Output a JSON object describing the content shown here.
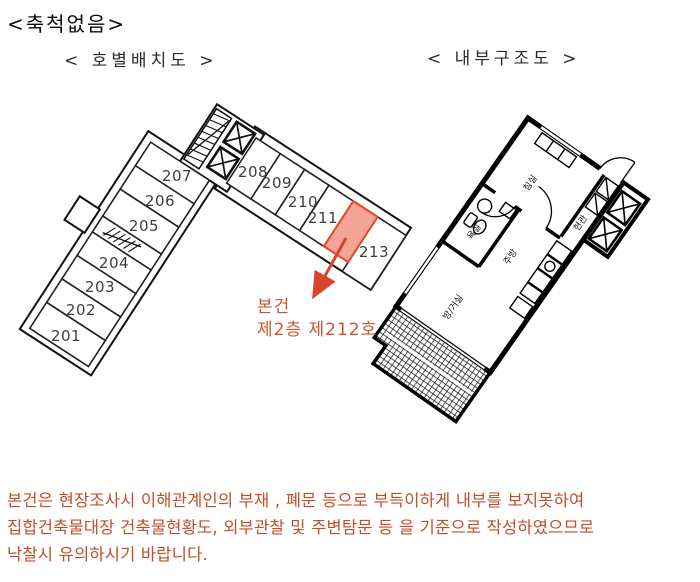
{
  "page_title": "<축척없음>",
  "layout_diagram": {
    "title": "< 호별배치도 >",
    "units": [
      {
        "no": "201"
      },
      {
        "no": "202"
      },
      {
        "no": "203"
      },
      {
        "no": "204"
      },
      {
        "no": "205"
      },
      {
        "no": "206"
      },
      {
        "no": "207"
      },
      {
        "no": "208"
      },
      {
        "no": "209"
      },
      {
        "no": "210"
      },
      {
        "no": "211"
      },
      {
        "no": "213"
      }
    ],
    "highlighted_unit": {
      "annotation_line1": "본건",
      "annotation_line2": "제2층 제212호"
    }
  },
  "floorplan_diagram": {
    "title": "< 내부구조도 >",
    "rooms": [
      {
        "name": "침실"
      },
      {
        "name": "욕실"
      },
      {
        "name": "주방"
      },
      {
        "name": "방/거실"
      },
      {
        "name": "현관"
      }
    ]
  },
  "notice": {
    "lines": [
      "본건은 현장조사시 이해관계인의  부재 ,  폐문 등으로 부득이하게 내부를 보지못하여",
      "집합건축물대장 건축물현황도, 외부관찰 및  주변탐문 등 을 기준으로 작성하였으므로",
      "낙찰시 유의하시기 바랍니다."
    ]
  },
  "colors": {
    "highlight_fill": "#F4A498",
    "highlight_stroke": "#DC4A28",
    "arrow": "#D9442B",
    "annotation_text": "#CE5530",
    "notice_text": "#C04E2B",
    "line_color": "#111111"
  }
}
